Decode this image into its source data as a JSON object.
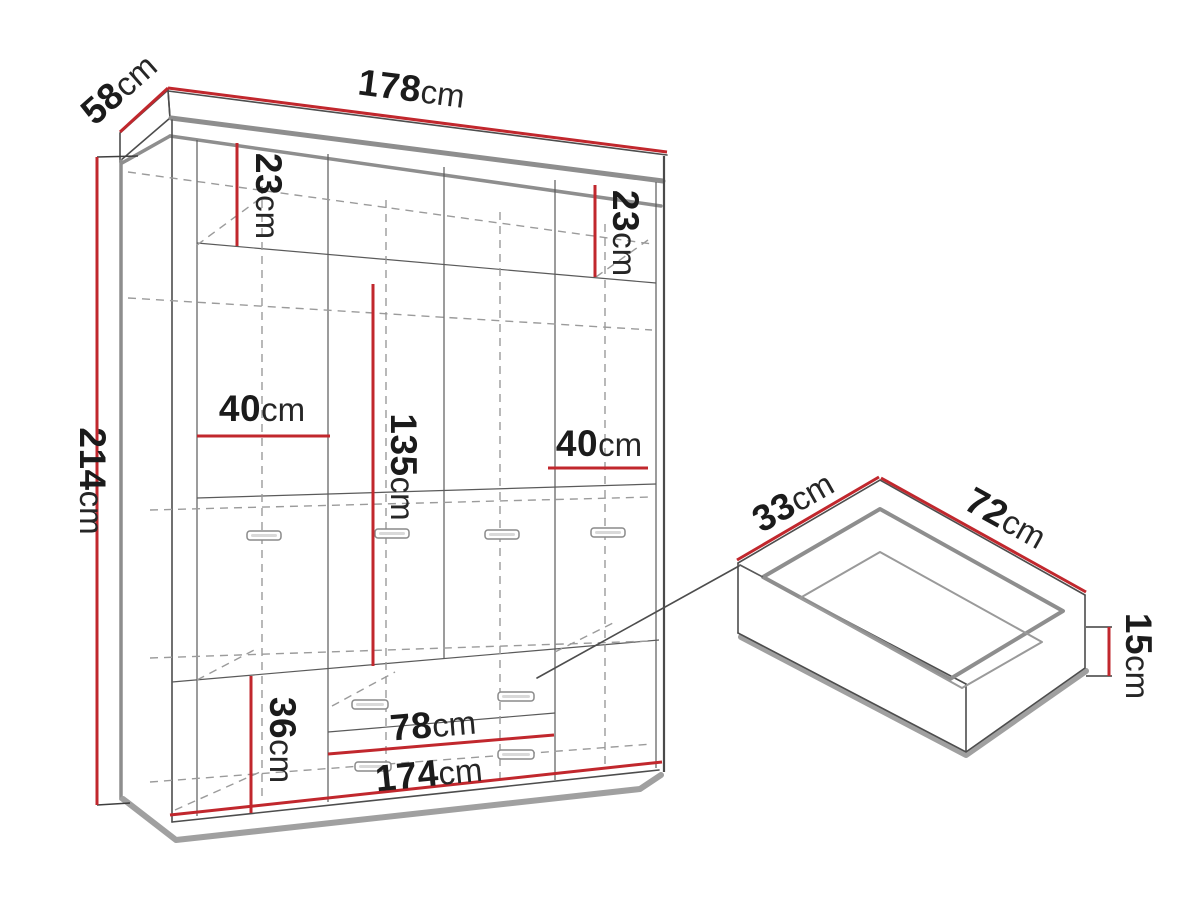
{
  "meta": {
    "description": "Wardrobe technical dimension diagram with detail view of pull-out drawer",
    "background": "#ffffff"
  },
  "colors": {
    "dimension_red": "#c1272d",
    "outline_dark": "#4d4d4d",
    "panel_gray": "#8e8e8e",
    "dashed_gray": "#9b9b9b",
    "text": "#1b1b1b"
  },
  "wardrobe": {
    "labels": {
      "width_top": {
        "value": "178",
        "unit": "cm"
      },
      "depth": {
        "value": "58",
        "unit": "cm"
      },
      "height": {
        "value": "214",
        "unit": "cm"
      },
      "top_compartment_left": {
        "value": "23",
        "unit": "cm"
      },
      "top_compartment_right": {
        "value": "23",
        "unit": "cm"
      },
      "side_section_left": {
        "value": "40",
        "unit": "cm"
      },
      "side_section_right": {
        "value": "40",
        "unit": "cm"
      },
      "hanging_space": {
        "value": "135",
        "unit": "cm"
      },
      "bottom_section": {
        "value": "36",
        "unit": "cm"
      },
      "drawer_width": {
        "value": "78",
        "unit": "cm"
      },
      "inner_width": {
        "value": "174",
        "unit": "cm"
      }
    }
  },
  "drawer_detail": {
    "labels": {
      "depth": {
        "value": "33",
        "unit": "cm"
      },
      "width": {
        "value": "72",
        "unit": "cm"
      },
      "height": {
        "value": "15",
        "unit": "cm"
      }
    }
  }
}
